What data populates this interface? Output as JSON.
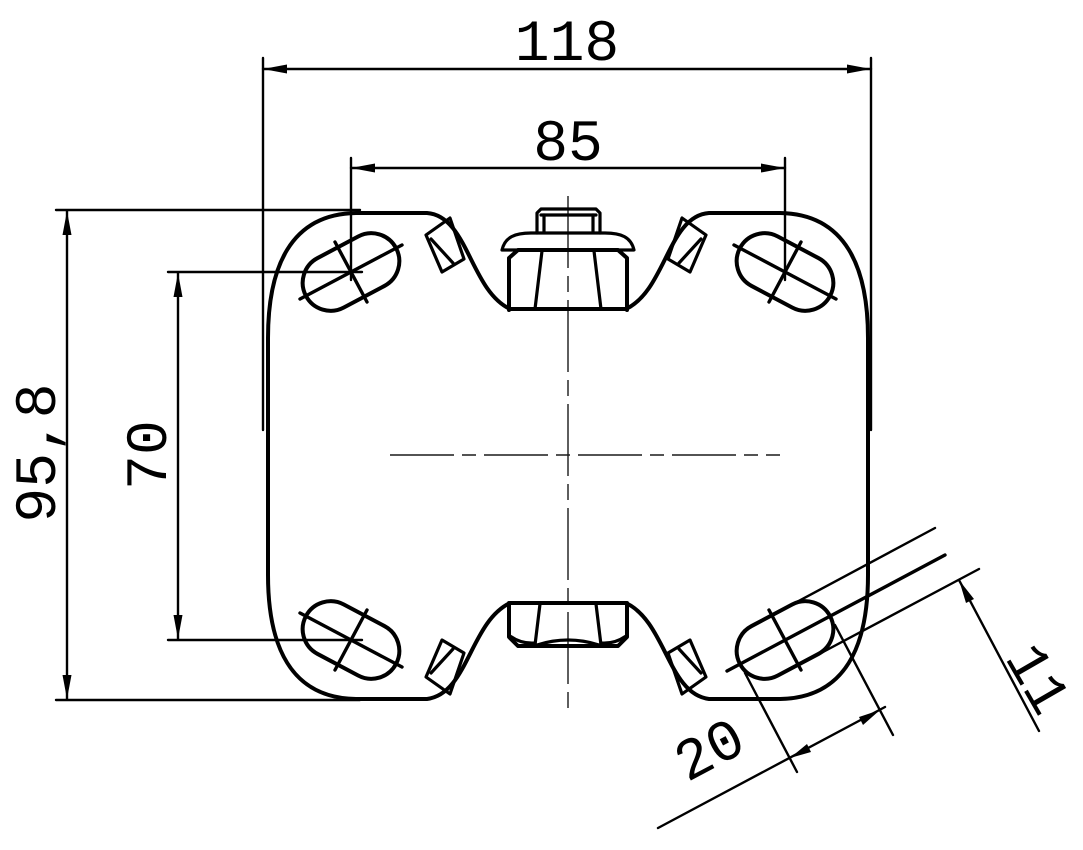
{
  "drawing": {
    "type": "technical-drawing",
    "subject": "caster-mounting-plate-top-view",
    "background": "#ffffff",
    "line_color": "#000000",
    "dimensions": {
      "overall_width": "118",
      "hole_spacing_horizontal": "85",
      "overall_height": "95,8",
      "hole_spacing_vertical": "70",
      "slot_length": "20",
      "slot_width": "11"
    }
  }
}
